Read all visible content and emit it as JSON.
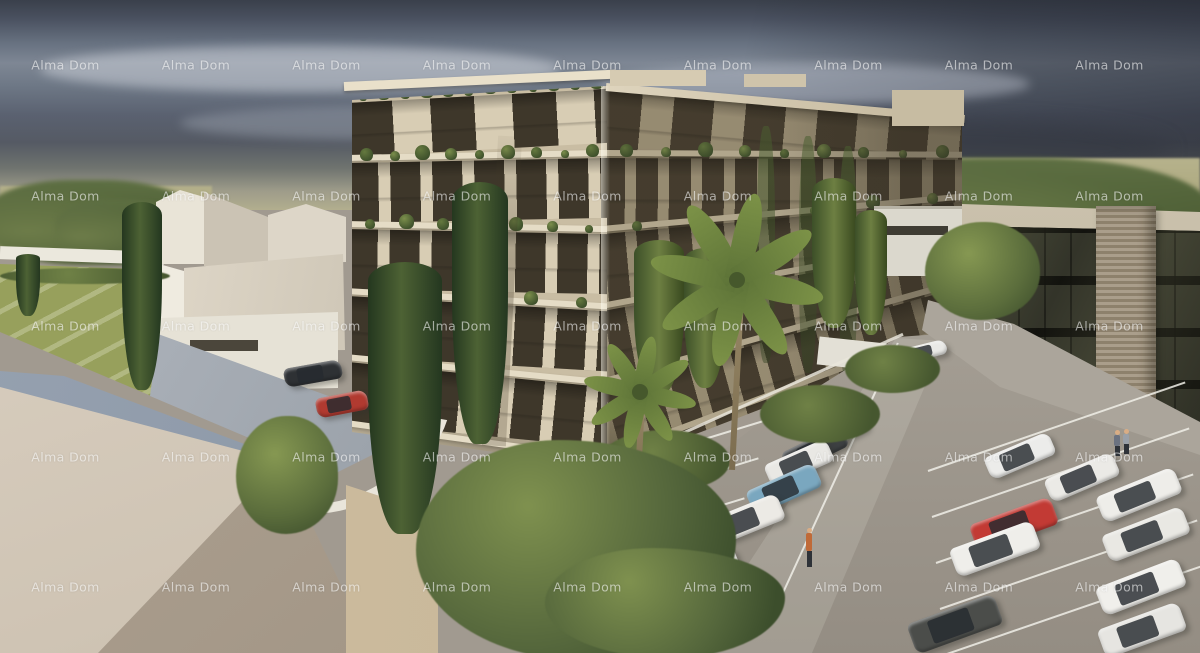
{
  "watermark": {
    "text": "Alma Dom",
    "color": "rgba(255,255,255,0.58)",
    "font_size_px": 12.5,
    "cols": 9,
    "rows": 5,
    "x0": 65.5,
    "y0": 65,
    "step_x": 130.5,
    "step_y": 130.5
  },
  "palette": {
    "sky_top": "#3a404b",
    "sky_mid": "#7e8794",
    "sky_low": "#555a64",
    "sky_haze": "#b2ae8e",
    "field": "#b0ac80",
    "lawn": "#97a05c",
    "green_dark": "#3f5230",
    "green_mid": "#5d7040",
    "green_light": "#8a9a55",
    "white_wall": "#eae6da",
    "roof_light": "#d8cfc0",
    "roof_dark": "#a3988a",
    "roof_fascia": "#8b97a6",
    "facade_cream": "#d8cdb4",
    "facade_window": "#3e372a",
    "facade_slab": "#e5dcc6",
    "facade_shadow_side": "#a89b7f",
    "office_glass": "#34352a",
    "office_brick": "#9d907a",
    "office_parapet": "#c9c0ab",
    "asphalt": "#a19a90",
    "stall_line": "#f0eee8",
    "driveway": "#a2a8b0",
    "car_red": "#c23a34",
    "car_blue": "#7aa7bf",
    "car_white": "#ecebe7",
    "car_silver": "#c6c7c9",
    "car_dark": "#3d4042"
  },
  "scene": {
    "main_building": {
      "faces": [
        {
          "name": "main-building-left-face",
          "x": 352,
          "y": 86,
          "w": 255,
          "h": 382,
          "top_l": 14,
          "top_r": 0,
          "bot_l": 346,
          "bot_r": 382,
          "clip": "polygon(0px 14px, 255px 0px, 255px 382px, 0px 346px)",
          "pier": "#d8cdb4",
          "win": "#3e372a",
          "slab": "#e5dcc6",
          "base": "#c9bda3",
          "slabs": [
            0.18,
            0.38,
            0.58,
            0.78,
            0.98
          ],
          "pent_period": [
            44,
            38
          ],
          "win_period": [
            30,
            12
          ],
          "tuft_rows": [
            {
              "f": 0.0,
              "n": 12
            },
            {
              "f": 0.18,
              "n": 9
            },
            {
              "f": 0.38,
              "n": 7
            },
            {
              "f": 0.58,
              "n": 5
            }
          ],
          "corner_shadow": true,
          "dark_overlay": false
        },
        {
          "name": "main-building-right-face",
          "x": 607,
          "y": 86,
          "w": 355,
          "h": 382,
          "top_l": 0,
          "top_r": 32,
          "bot_l": 382,
          "bot_r": 246,
          "clip": "polygon(0px 0px, 355px 32px, 355px 246px, 0px 382px)",
          "pier": "#a89b7f",
          "win": "#483f30",
          "slab": "#c7bb9f",
          "base": "#93876c",
          "slabs": [
            0.18,
            0.38,
            0.58,
            0.78,
            0.98
          ],
          "pent_period": [
            40,
            32
          ],
          "win_period": [
            22,
            11
          ],
          "tuft_rows": [
            {
              "f": 0.0,
              "n": 14
            },
            {
              "f": 0.18,
              "n": 9
            },
            {
              "f": 0.38,
              "n": 6
            }
          ],
          "corner_shadow": false,
          "dark_overlay": true
        }
      ]
    },
    "cars": [
      {
        "x": 836,
        "y": 434,
        "len": 64,
        "wid": 22,
        "angle": -28,
        "color": "#c6c7c9"
      },
      {
        "x": 815,
        "y": 449,
        "len": 66,
        "wid": 23,
        "angle": -26,
        "color": "#3d4042"
      },
      {
        "x": 799,
        "y": 463,
        "len": 68,
        "wid": 24,
        "angle": -24,
        "color": "#e9e8e4"
      },
      {
        "x": 784,
        "y": 489,
        "len": 74,
        "wid": 26,
        "angle": -24,
        "color": "#7aa7bf"
      },
      {
        "x": 743,
        "y": 521,
        "len": 82,
        "wid": 28,
        "angle": -22,
        "color": "#eceae5"
      },
      {
        "x": 700,
        "y": 573,
        "len": 80,
        "wid": 28,
        "angle": -22,
        "color": "#e2e1dd"
      },
      {
        "x": 955,
        "y": 624,
        "len": 92,
        "wid": 32,
        "angle": -20,
        "color": "#4b4d4a"
      },
      {
        "x": 1020,
        "y": 456,
        "len": 70,
        "wid": 24,
        "angle": -23,
        "color": "#ececea"
      },
      {
        "x": 1014,
        "y": 524,
        "len": 86,
        "wid": 29,
        "angle": -20,
        "color": "#c23a34"
      },
      {
        "x": 995,
        "y": 549,
        "len": 88,
        "wid": 30,
        "angle": -20,
        "color": "#efeeea"
      },
      {
        "x": 1082,
        "y": 477,
        "len": 74,
        "wid": 25,
        "angle": -23,
        "color": "#ebeae6"
      },
      {
        "x": 1139,
        "y": 495,
        "len": 84,
        "wid": 28,
        "angle": -22,
        "color": "#eeede9"
      },
      {
        "x": 1146,
        "y": 534,
        "len": 86,
        "wid": 29,
        "angle": -21,
        "color": "#e9e8e3"
      },
      {
        "x": 1141,
        "y": 587,
        "len": 88,
        "wid": 30,
        "angle": -21,
        "color": "#f0efeb"
      },
      {
        "x": 1142,
        "y": 630,
        "len": 86,
        "wid": 30,
        "angle": -20,
        "color": "#e6e5e1"
      },
      {
        "x": 313,
        "y": 373,
        "len": 58,
        "wid": 19,
        "angle": -10,
        "color": "#2e3134"
      },
      {
        "x": 342,
        "y": 404,
        "len": 52,
        "wid": 20,
        "angle": -11,
        "color": "#b13a30"
      },
      {
        "x": 924,
        "y": 351,
        "len": 46,
        "wid": 15,
        "angle": -14,
        "color": "#e9e9e6"
      }
    ],
    "people": [
      {
        "x": 804,
        "y": 528,
        "h": 44,
        "shirt": "#c06a38"
      },
      {
        "x": 1112,
        "y": 430,
        "h": 27,
        "shirt": "#6b7280"
      },
      {
        "x": 1121,
        "y": 429,
        "h": 26,
        "shirt": "#9aa0a8"
      }
    ],
    "parking_lines": [
      {
        "x": 672,
        "y": 448,
        "dx": -14,
        "dy": 40,
        "count": 6,
        "len": 105,
        "angle": -17
      },
      {
        "x": 928,
        "y": 470,
        "dx": 4,
        "dy": 46,
        "count": 5,
        "len": 272,
        "angle": -19
      },
      {
        "x": 770,
        "y": 620,
        "dx": 0,
        "dy": 0,
        "count": 1,
        "len": 306,
        "angle": -65.3
      }
    ],
    "greenery_back": [
      {
        "type": "treeline",
        "x": -15,
        "y": 180,
        "w": 215,
        "h": 85
      },
      {
        "type": "treeline",
        "x": 55,
        "y": 200,
        "w": 130,
        "h": 60
      },
      {
        "type": "treeline",
        "x": 826,
        "y": 158,
        "w": 384,
        "h": 112
      },
      {
        "type": "treeline",
        "x": 890,
        "y": 205,
        "w": 190,
        "h": 75
      }
    ],
    "greenery_front": [
      {
        "type": "bush",
        "x": 0,
        "y": 268,
        "w": 170,
        "h": 16
      },
      {
        "type": "cypress",
        "x": 16,
        "y": 254,
        "w": 24,
        "h": 62
      },
      {
        "type": "cypress",
        "x": 122,
        "y": 202,
        "w": 40,
        "h": 188
      },
      {
        "type": "tree",
        "x": 236,
        "y": 416,
        "w": 102,
        "h": 118
      },
      {
        "type": "cypress",
        "x": 368,
        "y": 262,
        "w": 74,
        "h": 272
      },
      {
        "type": "cypress",
        "x": 452,
        "y": 182,
        "w": 56,
        "h": 262
      },
      {
        "type": "poplar",
        "x": 634,
        "y": 240,
        "w": 50,
        "h": 155
      },
      {
        "type": "poplar",
        "x": 684,
        "y": 248,
        "w": 42,
        "h": 140
      },
      {
        "type": "poplar",
        "x": 812,
        "y": 178,
        "w": 44,
        "h": 150
      },
      {
        "type": "poplar",
        "x": 855,
        "y": 210,
        "w": 32,
        "h": 125
      },
      {
        "type": "bush",
        "x": 600,
        "y": 430,
        "w": 130,
        "h": 62
      },
      {
        "type": "bush",
        "x": 760,
        "y": 385,
        "w": 120,
        "h": 58
      },
      {
        "type": "bush",
        "x": 845,
        "y": 345,
        "w": 95,
        "h": 48
      },
      {
        "type": "tree",
        "x": 925,
        "y": 222,
        "w": 115,
        "h": 98
      },
      {
        "type": "palm",
        "x": 737,
        "y": 280,
        "r": 86,
        "trunk": 190
      },
      {
        "type": "palm",
        "x": 640,
        "y": 392,
        "r": 56,
        "trunk": 95
      },
      {
        "type": "mass",
        "x": 416,
        "y": 440,
        "w": 320,
        "h": 220
      },
      {
        "type": "mass",
        "x": 545,
        "y": 548,
        "w": 240,
        "h": 110
      }
    ]
  }
}
